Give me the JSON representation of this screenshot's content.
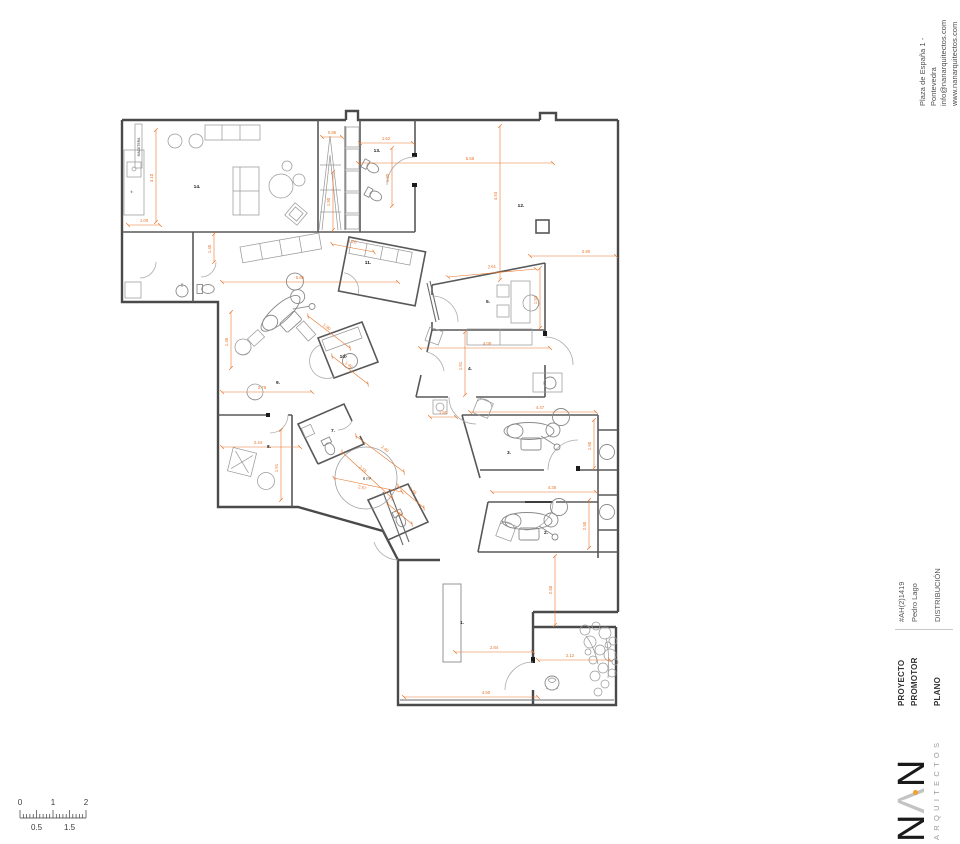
{
  "sheet": {
    "address_lines": [
      "Plaza de España 1 - Pontevedra",
      "info@nanarquitectos.com",
      "www.nanarquitectos.com"
    ],
    "titleblock": {
      "rows": [
        {
          "label": "PROYECTO",
          "value": "#AH(2)1419"
        },
        {
          "label": "PROMOTOR",
          "value": "Pedro Lago"
        },
        {
          "label": "PLANO",
          "value": "DISTRIBUCIÓN"
        }
      ]
    },
    "logo": {
      "n1": "N",
      "caret": "Λ",
      "n2": "N",
      "sub": "ARQUITECTOS"
    },
    "scalebar": {
      "top_marks": [
        {
          "t": "0",
          "x": 12
        },
        {
          "t": "1",
          "x": 45
        },
        {
          "t": "2",
          "x": 78
        }
      ],
      "bottom_marks": [
        {
          "t": "0.5",
          "x": 28.5
        },
        {
          "t": "1.5",
          "x": 61.5
        }
      ]
    }
  },
  "colors": {
    "dim": "#e8762c",
    "wall": "#4a4a4a",
    "furniture": "#9a9a9a",
    "logo_dot": "#f0a22e",
    "label": "#1d1d1d",
    "scale_text": "#3a3a3a"
  },
  "plan": {
    "room_labels": [
      {
        "text": "14.",
        "x": 197,
        "y": 188
      },
      {
        "text": "13.",
        "x": 377,
        "y": 152
      },
      {
        "text": "12.",
        "x": 521,
        "y": 207
      },
      {
        "text": "11.",
        "x": 368,
        "y": 264
      },
      {
        "text": "10.",
        "x": 343,
        "y": 358
      },
      {
        "text": "9.",
        "x": 278,
        "y": 384
      },
      {
        "text": "8.",
        "x": 269,
        "y": 448
      },
      {
        "text": "7.",
        "x": 333,
        "y": 432
      },
      {
        "text": "5.",
        "x": 488,
        "y": 303
      },
      {
        "text": "4.",
        "x": 470,
        "y": 370
      },
      {
        "text": "3.",
        "x": 509,
        "y": 454
      },
      {
        "text": "2.",
        "x": 546,
        "y": 534
      },
      {
        "text": "1.",
        "x": 462,
        "y": 624
      }
    ],
    "annotations": [
      {
        "text": "MACETERA",
        "x": 140,
        "y": 147,
        "rot": -90,
        "size": 3.4
      },
      {
        "text": "fr.",
        "x": 132,
        "y": 193,
        "rot": 0,
        "size": 3.2
      },
      {
        "text": "6 m²",
        "x": 367,
        "y": 480,
        "rot": 0,
        "size": 4.2
      }
    ],
    "dims": [
      {
        "label": "1.00",
        "line": [
          128,
          225,
          160,
          225
        ],
        "lx": 144,
        "ly": 222,
        "lrot": 0
      },
      {
        "label": "3.10",
        "line": [
          156,
          130,
          156,
          222
        ],
        "lx": 153,
        "ly": 178,
        "lrot": -90
      },
      {
        "label": "0.86",
        "line": [
          322,
          137,
          342,
          137
        ],
        "lx": 332,
        "ly": 134,
        "lrot": 0
      },
      {
        "label": "1.62",
        "line": [
          360,
          143,
          413,
          143
        ],
        "lx": 386,
        "ly": 140,
        "lrot": 0
      },
      {
        "label": "1.80",
        "line": [
          392,
          148,
          392,
          206
        ],
        "lx": 389,
        "ly": 178,
        "lrot": -90
      },
      {
        "label": "1.90",
        "line": [
          333,
          172,
          333,
          230
        ],
        "lx": 330,
        "ly": 202,
        "lrot": -90
      },
      {
        "label": "5.58",
        "line": [
          358,
          163,
          553,
          163
        ],
        "lx": 470,
        "ly": 160,
        "lrot": 0
      },
      {
        "label": "4.93",
        "line": [
          500,
          126,
          500,
          280
        ],
        "lx": 497,
        "ly": 196,
        "lrot": -90
      },
      {
        "label": "2.90",
        "line": [
          530,
          256,
          616,
          256
        ],
        "lx": 586,
        "ly": 253,
        "lrot": 0
      },
      {
        "label": "5.65",
        "line": [
          222,
          282,
          398,
          282
        ],
        "lx": 300,
        "ly": 279,
        "lrot": 0
      },
      {
        "label": "1.20",
        "line": [
          332,
          244,
          374,
          252
        ],
        "lx": 352,
        "ly": 243,
        "lrot": 11
      },
      {
        "label": "2.78",
        "line": [
          222,
          392,
          312,
          392
        ],
        "lx": 262,
        "ly": 389,
        "lrot": 0
      },
      {
        "label": "1.45",
        "line": [
          231,
          312,
          231,
          368
        ],
        "lx": 228,
        "ly": 342,
        "lrot": -90
      },
      {
        "label": "1.45",
        "line": [
          214,
          234,
          214,
          262
        ],
        "lx": 211,
        "ly": 249,
        "lrot": -90
      },
      {
        "label": "2.61",
        "line": [
          448,
          277,
          536,
          269
        ],
        "lx": 492,
        "ly": 268,
        "lrot": -5
      },
      {
        "label": "1.93",
        "line": [
          540,
          268,
          540,
          328
        ],
        "lx": 537,
        "ly": 300,
        "lrot": -90
      },
      {
        "label": "4.08",
        "line": [
          420,
          348,
          550,
          348
        ],
        "lx": 487,
        "ly": 345,
        "lrot": 0
      },
      {
        "label": "1.91",
        "line": [
          465,
          332,
          465,
          395
        ],
        "lx": 462,
        "ly": 366,
        "lrot": -90
      },
      {
        "label": "1.50",
        "line": [
          430,
          417,
          456,
          417
        ],
        "lx": 443,
        "ly": 414,
        "lrot": 0
      },
      {
        "label": "4.47",
        "line": [
          470,
          412,
          596,
          412
        ],
        "lx": 540,
        "ly": 409,
        "lrot": 0
      },
      {
        "label": "1.90",
        "line": [
          594,
          420,
          594,
          468
        ],
        "lx": 591,
        "ly": 446,
        "lrot": -90
      },
      {
        "label": "4.35",
        "line": [
          492,
          492,
          596,
          492
        ],
        "lx": 552,
        "ly": 489,
        "lrot": 0
      },
      {
        "label": "2.50",
        "line": [
          589,
          500,
          589,
          548
        ],
        "lx": 586,
        "ly": 526,
        "lrot": -90
      },
      {
        "label": "2.44",
        "line": [
          222,
          447,
          300,
          447
        ],
        "lx": 258,
        "ly": 444,
        "lrot": 0
      },
      {
        "label": "1.91",
        "line": [
          281,
          430,
          281,
          500
        ],
        "lx": 278,
        "ly": 468,
        "lrot": -90
      },
      {
        "label": "2.16",
        "line": [
          342,
          452,
          392,
          498
        ],
        "lx": 362,
        "ly": 470,
        "lrot": 42
      },
      {
        "label": "2.67",
        "line": [
          334,
          478,
          402,
          492
        ],
        "lx": 362,
        "ly": 489,
        "lrot": 12
      },
      {
        "label": "2.40",
        "line": [
          356,
          436,
          404,
          472
        ],
        "lx": 384,
        "ly": 450,
        "lrot": 37
      },
      {
        "label": "1.90",
        "line": [
          308,
          316,
          350,
          348
        ],
        "lx": 326,
        "ly": 328,
        "lrot": 37
      },
      {
        "label": "1.40",
        "line": [
          332,
          356,
          368,
          384
        ],
        "lx": 348,
        "ly": 366,
        "lrot": 37
      },
      {
        "label": "1.46",
        "line": [
          398,
          486,
          424,
          508
        ],
        "lx": 412,
        "ly": 492,
        "lrot": 40
      },
      {
        "label": "1.10",
        "line": [
          388,
          504,
          412,
          524
        ],
        "lx": 398,
        "ly": 514,
        "lrot": 40
      },
      {
        "label": "2.84",
        "line": [
          455,
          652,
          533,
          652
        ],
        "lx": 494,
        "ly": 649,
        "lrot": 0
      },
      {
        "label": "4.50",
        "line": [
          404,
          697,
          538,
          697
        ],
        "lx": 486,
        "ly": 694,
        "lrot": 0
      },
      {
        "label": "2.12",
        "line": [
          538,
          660,
          610,
          660
        ],
        "lx": 570,
        "ly": 657,
        "lrot": 0
      },
      {
        "label": "2.50",
        "line": [
          555,
          556,
          555,
          625
        ],
        "lx": 552,
        "ly": 590,
        "lrot": -90
      }
    ]
  }
}
